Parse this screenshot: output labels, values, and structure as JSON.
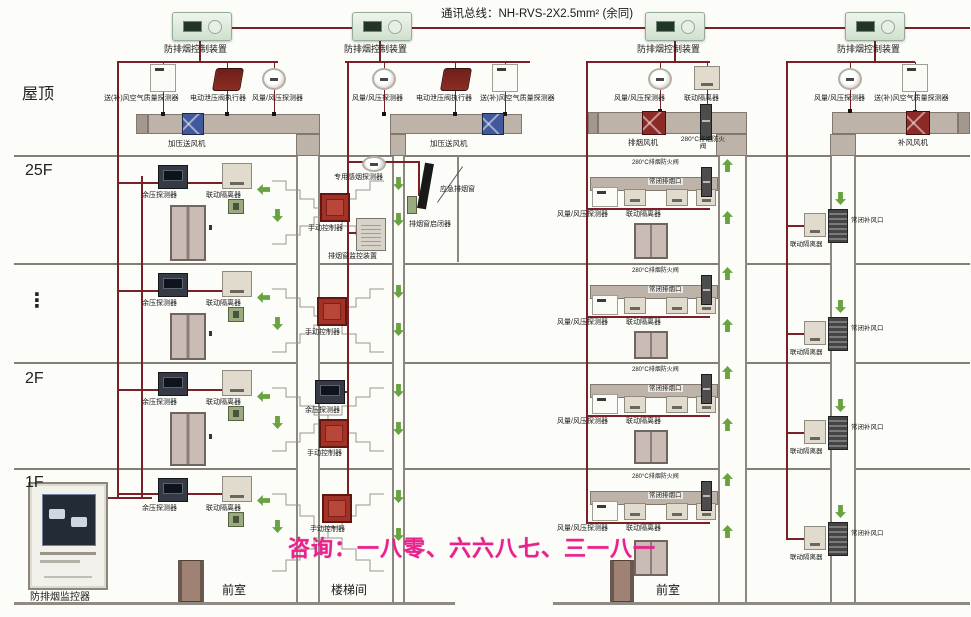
{
  "bus_title": "通讯总线：NH-RVS-2X2.5mm² (余同)",
  "controller": "防排烟控制装置",
  "floors": {
    "roof": "屋顶",
    "f25": "25F",
    "ellipsis": "⋮",
    "f2": "2F",
    "f1": "1F"
  },
  "labels": {
    "air_quality": "送(补)风空气质量探测器",
    "valve_actuator": "电动泄压阀执行器",
    "flow_detector": "风量/风压探测器",
    "supply_fan": "加压送风机",
    "exhaust_fan": "排烟风机",
    "makeup_fan": "补风风机",
    "damper280": "280°C排烟防火阀",
    "pressure_detector": "余压探测器",
    "isolator": "联动隔离器",
    "manual": "手动控制器",
    "smoke_detector": "专用感烟探测器",
    "vent_monitor": "排烟窗监控装置",
    "vent_opener": "排烟窗启闭器",
    "emergency_vent": "应急排烟窗",
    "closed_exhaust_vent": "常闭排烟口",
    "closed_makeup_vent": "常闭补风口",
    "monitor": "防排烟监控器",
    "anteroom": "前室",
    "stairwell": "楼梯间"
  },
  "watermark": "咨询：一八零、六六八七、三一八一",
  "colors": {
    "bus": "#7a2128",
    "duct": "#beb3a9",
    "fan_blue": "#41599c",
    "fan_red": "#8c2a28",
    "arrow_green": "#69a340",
    "manual_red": "#a23128",
    "watermark_pink": "#e8218c"
  }
}
